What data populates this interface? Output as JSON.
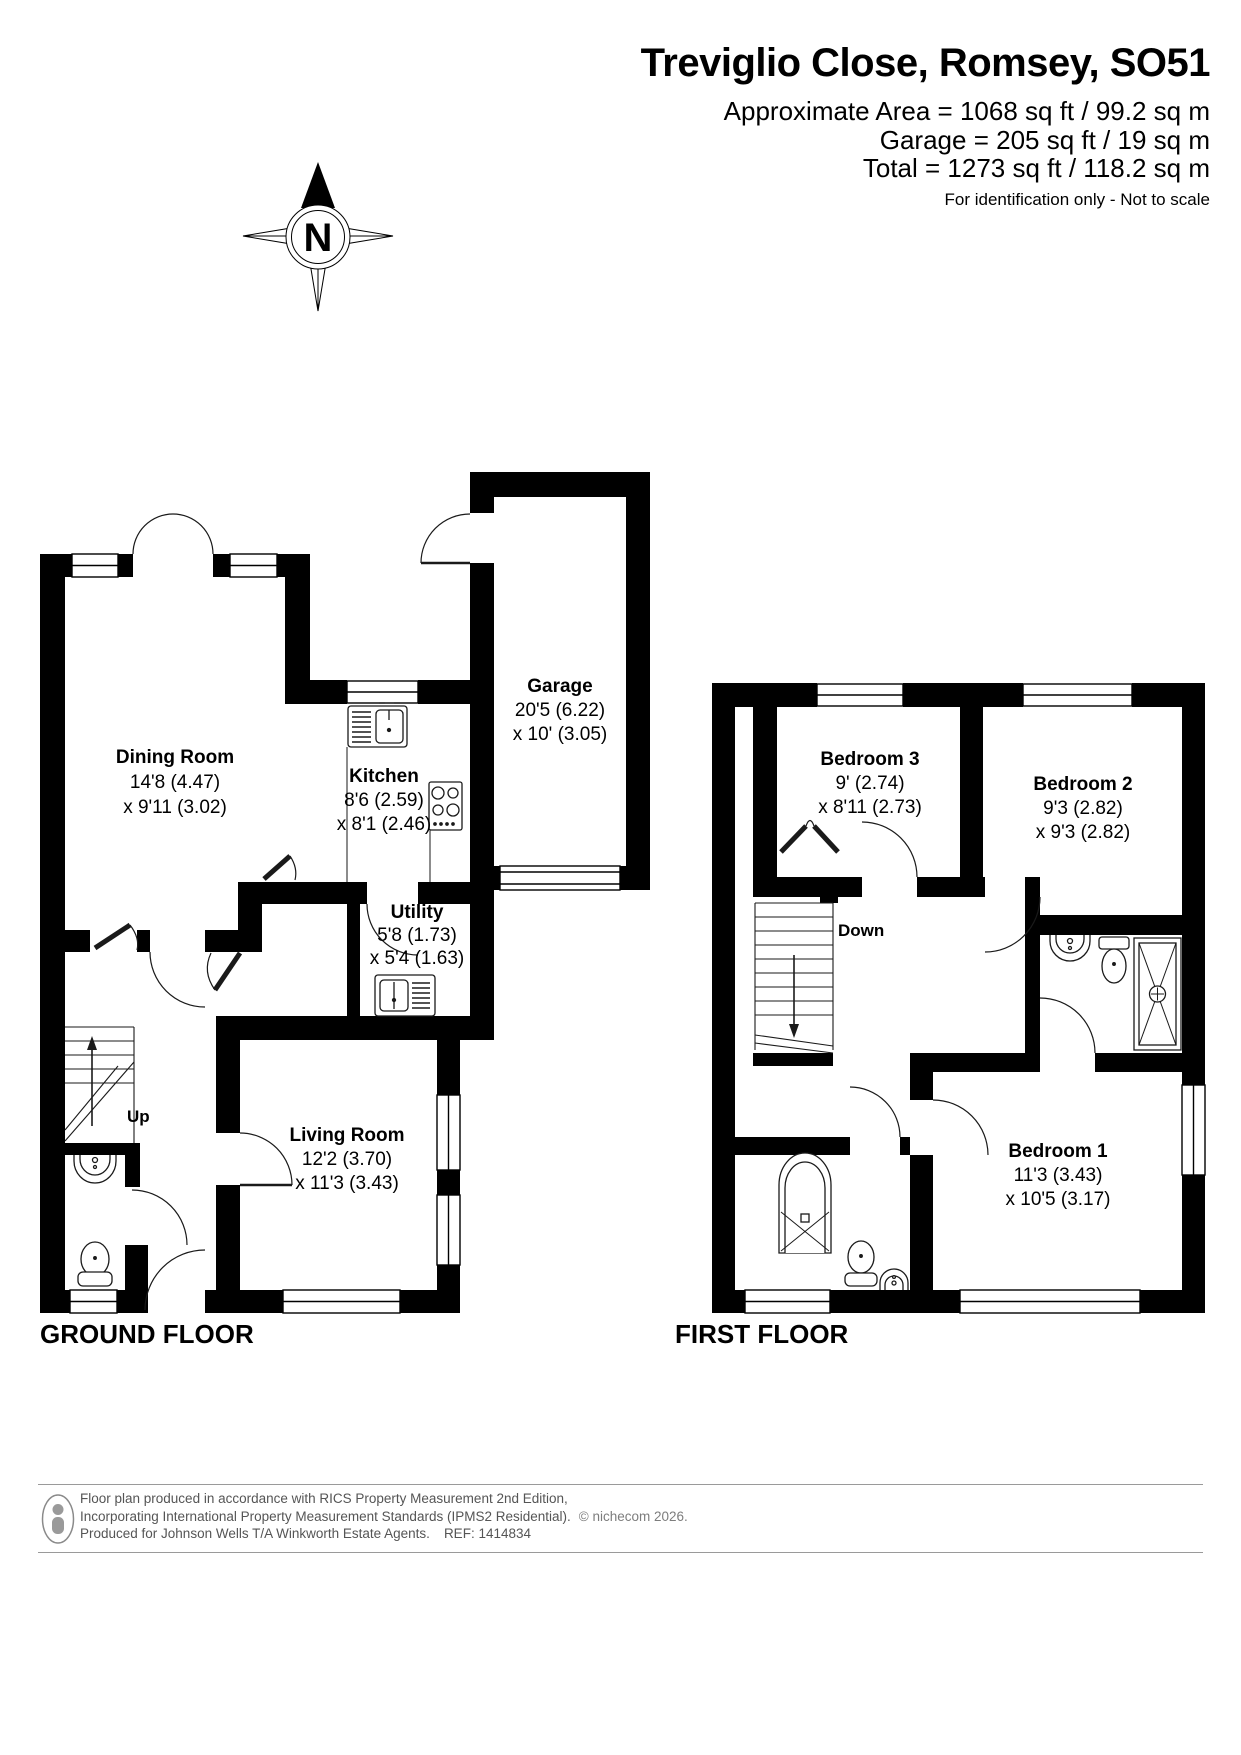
{
  "header": {
    "title": "Treviglio Close, Romsey, SO51",
    "area_line1": "Approximate Area = 1068 sq ft / 99.2 sq m",
    "area_line2": "Garage = 205 sq ft / 19 sq m",
    "area_line3": "Total = 1273 sq ft / 118.2 sq m",
    "disclaimer": "For identification only - Not to scale"
  },
  "compass": {
    "label": "N"
  },
  "floors": {
    "ground": {
      "label": "GROUND FLOOR",
      "stairs_label": "Up",
      "rooms": {
        "dining": {
          "name": "Dining Room",
          "dim1": "14'8 (4.47)",
          "dim2": "x 9'11 (3.02)"
        },
        "kitchen": {
          "name": "Kitchen",
          "dim1": "8'6 (2.59)",
          "dim2": "x 8'1 (2.46)"
        },
        "garage": {
          "name": "Garage",
          "dim1": "20'5 (6.22)",
          "dim2": "x 10' (3.05)"
        },
        "utility": {
          "name": "Utility",
          "dim1": "5'8 (1.73)",
          "dim2": "x 5'4 (1.63)"
        },
        "living": {
          "name": "Living Room",
          "dim1": "12'2 (3.70)",
          "dim2": "x 11'3 (3.43)"
        }
      }
    },
    "first": {
      "label": "FIRST FLOOR",
      "stairs_label": "Down",
      "rooms": {
        "bedroom3": {
          "name": "Bedroom 3",
          "dim1": "9' (2.74)",
          "dim2": "x 8'11 (2.73)"
        },
        "bedroom2": {
          "name": "Bedroom 2",
          "dim1": "9'3 (2.82)",
          "dim2": "x 9'3 (2.82)"
        },
        "bedroom1": {
          "name": "Bedroom 1",
          "dim1": "11'3 (3.43)",
          "dim2": "x 10'5 (3.17)"
        }
      }
    }
  },
  "footer": {
    "line1": "Floor plan produced in accordance with RICS Property Measurement 2nd Edition,",
    "line2": "Incorporating International Property Measurement Standards (IPMS2 Residential).",
    "line2b": "© nichecom 2026.",
    "line3": "Produced for Johnson Wells T/A Winkworth Estate Agents.",
    "line3b": "REF: 1414834"
  },
  "colors": {
    "wall": "#000000",
    "fixture_line": "#1a1a1a",
    "footer_rule": "#9a9a9a",
    "footer_text": "#555555",
    "footer_muted": "#7d7d7d"
  }
}
